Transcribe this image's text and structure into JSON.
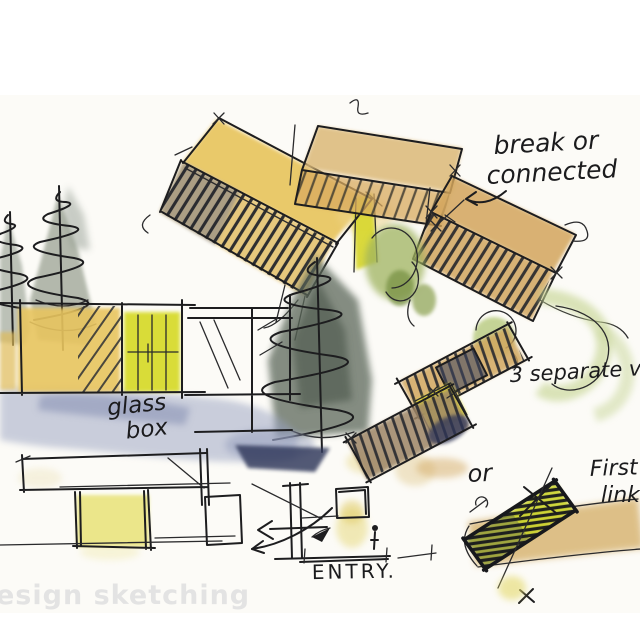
{
  "annotations": {
    "break_or": {
      "line1": "break or",
      "line2": "connected"
    },
    "three_rooms": {
      "text": "3 separate vol"
    },
    "glass_box": {
      "line1": "glass",
      "line2": "box"
    },
    "or_label": {
      "text": "or"
    },
    "first_link": {
      "line1": "First",
      "line2": "link"
    },
    "entry": {
      "text": "ENTRY."
    }
  },
  "watermark": {
    "text": "esign sketching",
    "color": "#e3e3e3"
  },
  "palette": {
    "ink": "#1d1d1f",
    "gold_wash": "#e8c55e",
    "ochre_wash": "#d2a75f",
    "bright_yellow_green": "#d8db2f",
    "blue_wash": "#98a1c0",
    "navy_accent": "#343c5e",
    "tree_green": "#5c675a",
    "leaf_green": "#9fb35e",
    "pale_green": "#c7d695",
    "paper": "#ffffff"
  }
}
